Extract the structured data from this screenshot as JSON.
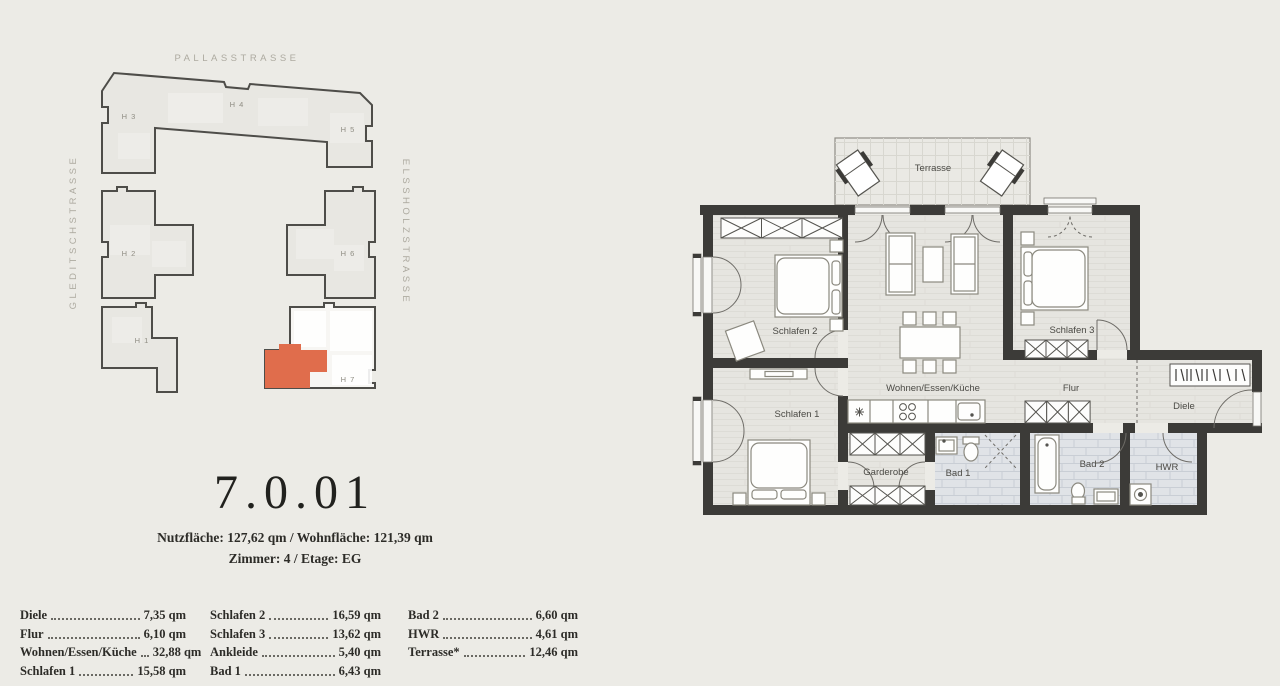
{
  "site_plan": {
    "streets": {
      "top": "PALLASSTRASSE",
      "left": "GLEDITSCHSTRASSE",
      "right": "ELSSHOLZSTRASSE"
    },
    "houses": [
      {
        "label": "H 3"
      },
      {
        "label": "H 4"
      },
      {
        "label": "H 5"
      },
      {
        "label": "H 2"
      },
      {
        "label": "H 6"
      },
      {
        "label": "H 1"
      },
      {
        "label": "H 7"
      }
    ],
    "highlight_color": "#e06d4c"
  },
  "unit": {
    "number": "7.0.01",
    "info_line1": "Nutzfläche: 127,62 qm / Wohnfläche: 121,39 qm",
    "info_line2": "Zimmer: 4 / Etage: EG"
  },
  "room_list": {
    "columns": [
      [
        {
          "name": "Diele",
          "area": "7,35 qm"
        },
        {
          "name": "Flur",
          "area": "6,10 qm"
        },
        {
          "name": "Wohnen/Essen/Küche",
          "area": "32,88 qm"
        },
        {
          "name": "Schlafen 1",
          "area": "15,58 qm"
        }
      ],
      [
        {
          "name": "Schlafen 2",
          "area": "16,59 qm"
        },
        {
          "name": "Schlafen 3",
          "area": "13,62 qm"
        },
        {
          "name": "Ankleide",
          "area": "5,40 qm"
        },
        {
          "name": "Bad 1",
          "area": "6,43 qm"
        }
      ],
      [
        {
          "name": "Bad 2",
          "area": "6,60 qm"
        },
        {
          "name": "HWR",
          "area": "4,61 qm"
        },
        {
          "name": "Terrasse*",
          "area": "12,46 qm"
        }
      ]
    ]
  },
  "floor_plan": {
    "rooms": {
      "terrasse": "Terrasse",
      "schlafen1": "Schlafen 1",
      "schlafen2": "Schlafen 2",
      "schlafen3": "Schlafen 3",
      "wohnen": "Wohnen/Essen/Küche",
      "flur": "Flur",
      "diele": "Diele",
      "garderobe": "Garderobe",
      "bad1": "Bad 1",
      "bad2": "Bad 2",
      "hwr": "HWR"
    },
    "colors": {
      "wall": "#3c3b38",
      "floor": "#e6e5e0",
      "tile": "#e0e3e7",
      "accent": "#e06d4c"
    }
  }
}
